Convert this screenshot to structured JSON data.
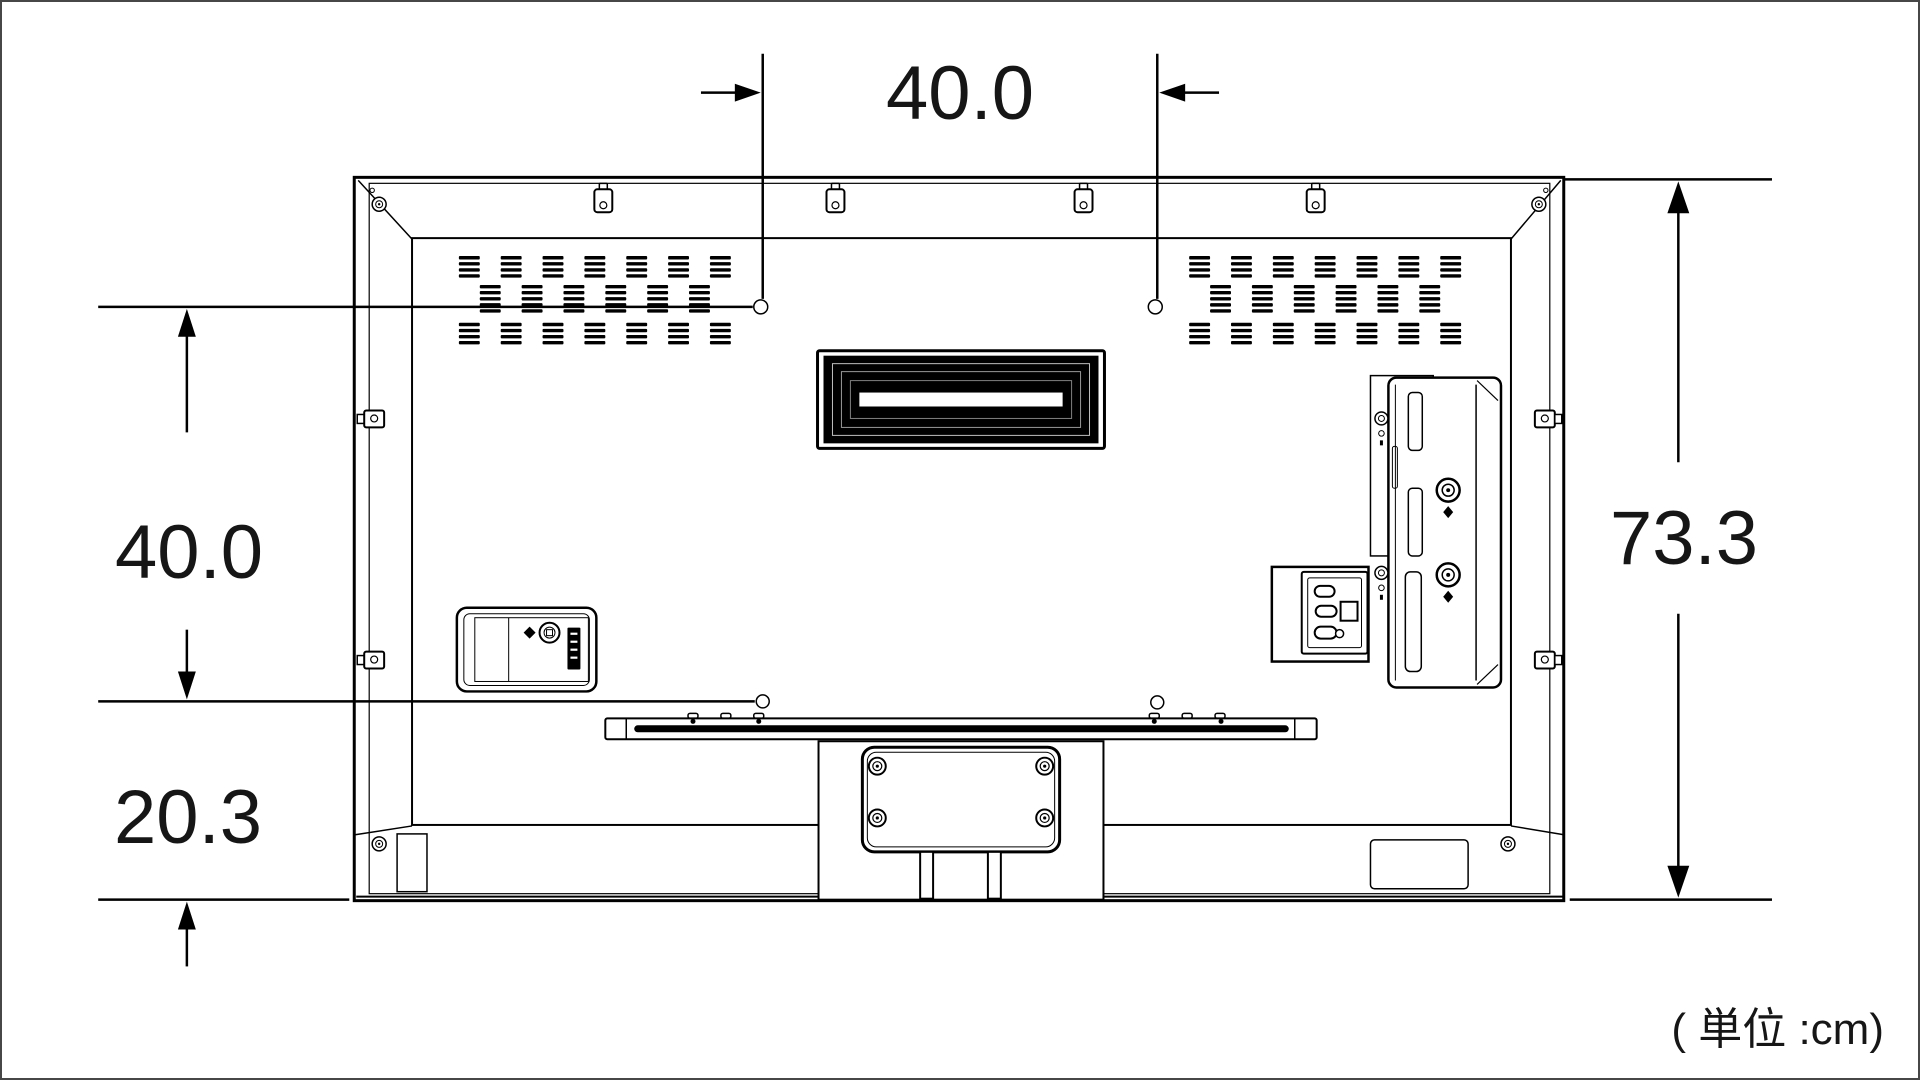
{
  "title": "tv-rear-panel-dimension-diagram",
  "units_label": "( 単位 :cm)",
  "dimensions": {
    "mount_width_cm": "40.0",
    "mount_height_cm": "40.0",
    "bottom_offset_cm": "20.3",
    "total_height_cm": "73.3"
  },
  "colors": {
    "line": "#000000",
    "background": "#ffffff",
    "canvas_frame": "#474747"
  }
}
